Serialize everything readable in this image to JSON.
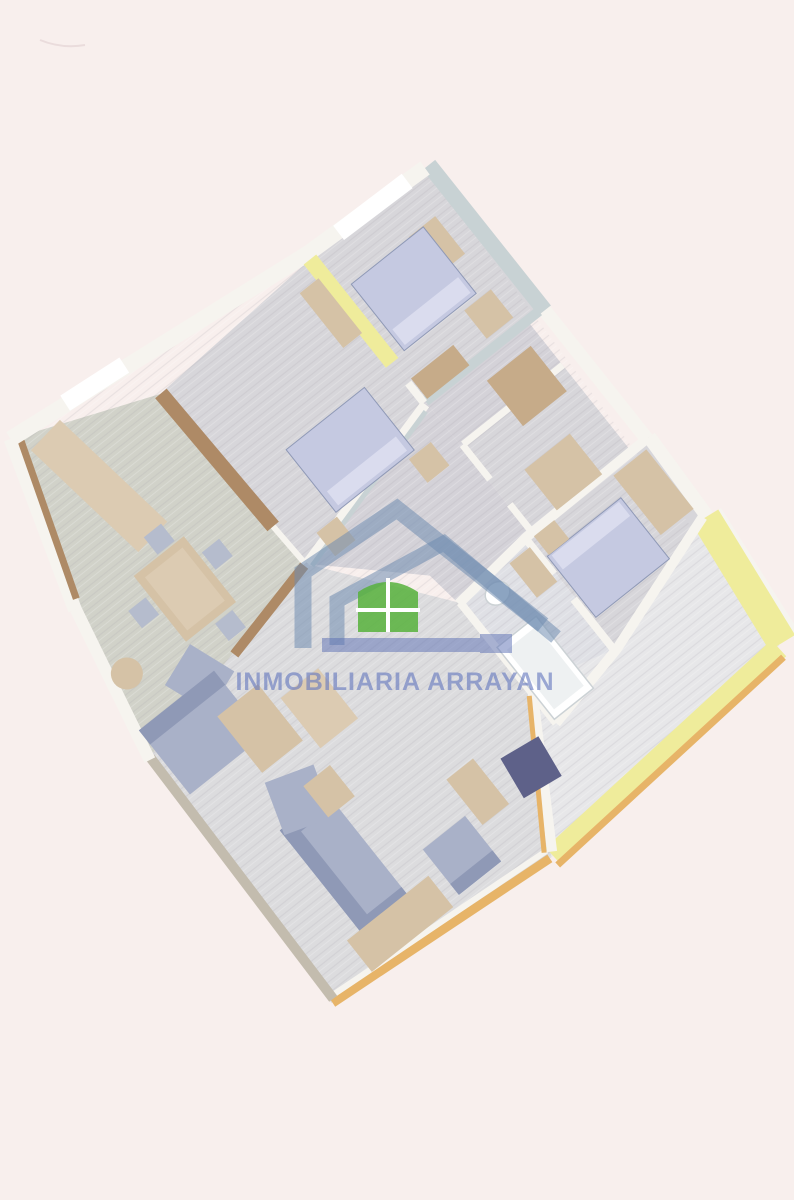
{
  "watermark": {
    "text": "INMOBILIARIA ARRAYAN",
    "logo_icon": "house-roof-with-window-icon"
  },
  "palette": {
    "bg": "#f8efed",
    "white": "#ffffff",
    "wallWhite": "#f6f4ef",
    "wallGray": "#c8d2d4",
    "wallYellow": "#efec9b",
    "wallOrange": "#e7b468",
    "wallBrown": "#ae8a66",
    "wallTan": "#c3bcae",
    "floorWood": "#d7d6da",
    "floorHall": "#d4d2d8",
    "floorDining": "#d1d2c9",
    "floorBath": "#dfe0e5",
    "floorTerrace": "#e7e7e9",
    "floorLiving": "#dcdcde",
    "boardLine": "#aaa4ae",
    "bedBlue": "#c5c9e1",
    "bedPillow": "#dadcee",
    "sofaBlue": "#a9b1c8",
    "sofaDark": "#8f99b6",
    "chairBlue": "#b5bccd",
    "chairNavy": "#5e6189",
    "woodTan": "#d5c2a6",
    "woodDark": "#c6ab89",
    "woodLight": "#dccbb2",
    "logoBlue": "#6f8cb0",
    "logoGreen": "#57b13c",
    "logoBar": "#5a6eb4",
    "textBlue": "#6478be"
  }
}
